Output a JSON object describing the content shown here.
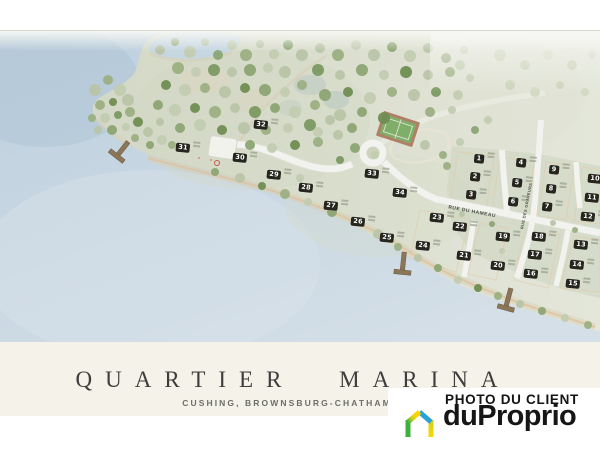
{
  "poster": {
    "title": "QUARTIER MARINA",
    "subtitle": "CUSHING, BROWNSBURG-CHATHAM"
  },
  "badge": {
    "label": "PHOTO DU CLIENT",
    "brand": "duProprio"
  },
  "map": {
    "streets": [
      {
        "name": "RUE DU HAMEAU"
      },
      {
        "name": "RUE DES GRAVEURS"
      }
    ],
    "lots": [
      {
        "n": "1",
        "x": 479,
        "y": 159
      },
      {
        "n": "2",
        "x": 475,
        "y": 177
      },
      {
        "n": "3",
        "x": 471,
        "y": 195
      },
      {
        "n": "4",
        "x": 521,
        "y": 163
      },
      {
        "n": "5",
        "x": 517,
        "y": 183
      },
      {
        "n": "6",
        "x": 513,
        "y": 202
      },
      {
        "n": "7",
        "x": 547,
        "y": 207
      },
      {
        "n": "8",
        "x": 551,
        "y": 189
      },
      {
        "n": "9",
        "x": 554,
        "y": 170
      },
      {
        "n": "10",
        "x": 595,
        "y": 179
      },
      {
        "n": "11",
        "x": 592,
        "y": 198
      },
      {
        "n": "12",
        "x": 588,
        "y": 217
      },
      {
        "n": "13",
        "x": 581,
        "y": 245
      },
      {
        "n": "14",
        "x": 577,
        "y": 265
      },
      {
        "n": "15",
        "x": 573,
        "y": 284
      },
      {
        "n": "16",
        "x": 531,
        "y": 274
      },
      {
        "n": "17",
        "x": 535,
        "y": 255
      },
      {
        "n": "18",
        "x": 539,
        "y": 237
      },
      {
        "n": "19",
        "x": 503,
        "y": 237
      },
      {
        "n": "20",
        "x": 498,
        "y": 266
      },
      {
        "n": "21",
        "x": 464,
        "y": 256
      },
      {
        "n": "22",
        "x": 460,
        "y": 227
      },
      {
        "n": "23",
        "x": 437,
        "y": 218
      },
      {
        "n": "24",
        "x": 423,
        "y": 246
      },
      {
        "n": "25",
        "x": 387,
        "y": 238
      },
      {
        "n": "26",
        "x": 358,
        "y": 222
      },
      {
        "n": "27",
        "x": 331,
        "y": 206
      },
      {
        "n": "28",
        "x": 306,
        "y": 188
      },
      {
        "n": "29",
        "x": 274,
        "y": 175
      },
      {
        "n": "30",
        "x": 240,
        "y": 158
      },
      {
        "n": "31",
        "x": 183,
        "y": 148
      },
      {
        "n": "32",
        "x": 261,
        "y": 125
      },
      {
        "n": "33",
        "x": 372,
        "y": 174
      },
      {
        "n": "34",
        "x": 400,
        "y": 193
      }
    ],
    "colors": {
      "water": "#c3d4e1",
      "land": "#d7dbc9",
      "road": "#f2f3ee",
      "block_edge": "#e4c9a8",
      "lot_tag": "#26261f",
      "cream_band": "#f4f2e9"
    }
  }
}
